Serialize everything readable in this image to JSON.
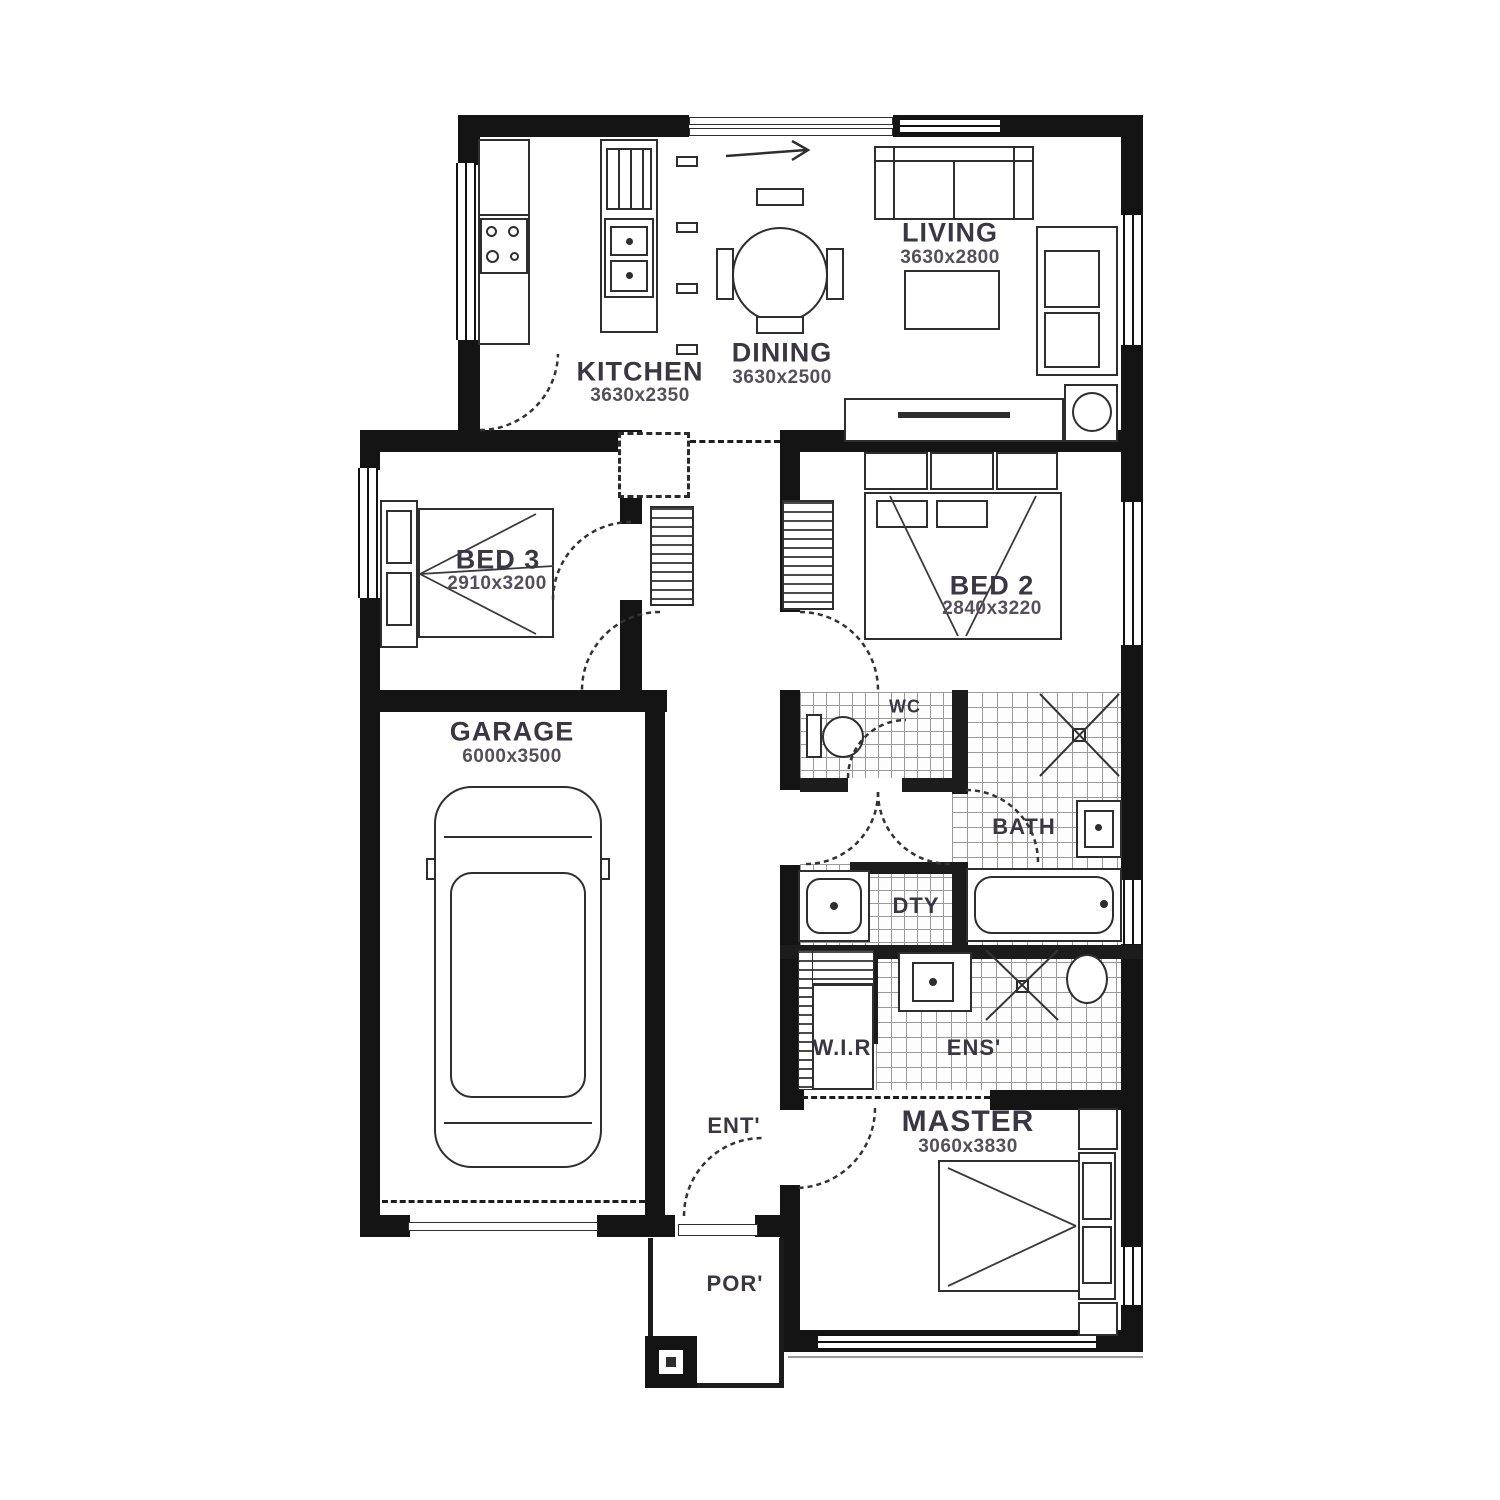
{
  "plan": {
    "type": "residential-floor-plan",
    "rooms": [
      {
        "id": "living",
        "label": "LIVING",
        "dims": "3630x2800"
      },
      {
        "id": "dining",
        "label": "DINING",
        "dims": "3630x2500"
      },
      {
        "id": "kitchen",
        "label": "KITCHEN",
        "dims": "3630x2350"
      },
      {
        "id": "bed3",
        "label": "BED 3",
        "dims": "2910x3200"
      },
      {
        "id": "bed2",
        "label": "BED 2",
        "dims": "2840x3220"
      },
      {
        "id": "garage",
        "label": "GARAGE",
        "dims": "6000x3500"
      },
      {
        "id": "master",
        "label": "MASTER",
        "dims": "3060x3830"
      },
      {
        "id": "wc",
        "label": "WC"
      },
      {
        "id": "bath",
        "label": "BATH"
      },
      {
        "id": "laundry",
        "label": "DTY"
      },
      {
        "id": "wir",
        "label": "W.I.R"
      },
      {
        "id": "ensuite",
        "label": "ENS'"
      },
      {
        "id": "entry",
        "label": "ENT'"
      },
      {
        "id": "porch",
        "label": "POR'"
      }
    ],
    "colors": {
      "wall": "#141414",
      "line": "#2e2e2e",
      "label": "#3b3644",
      "dim": "#554f5c",
      "tile": "#9a9a9a"
    }
  }
}
